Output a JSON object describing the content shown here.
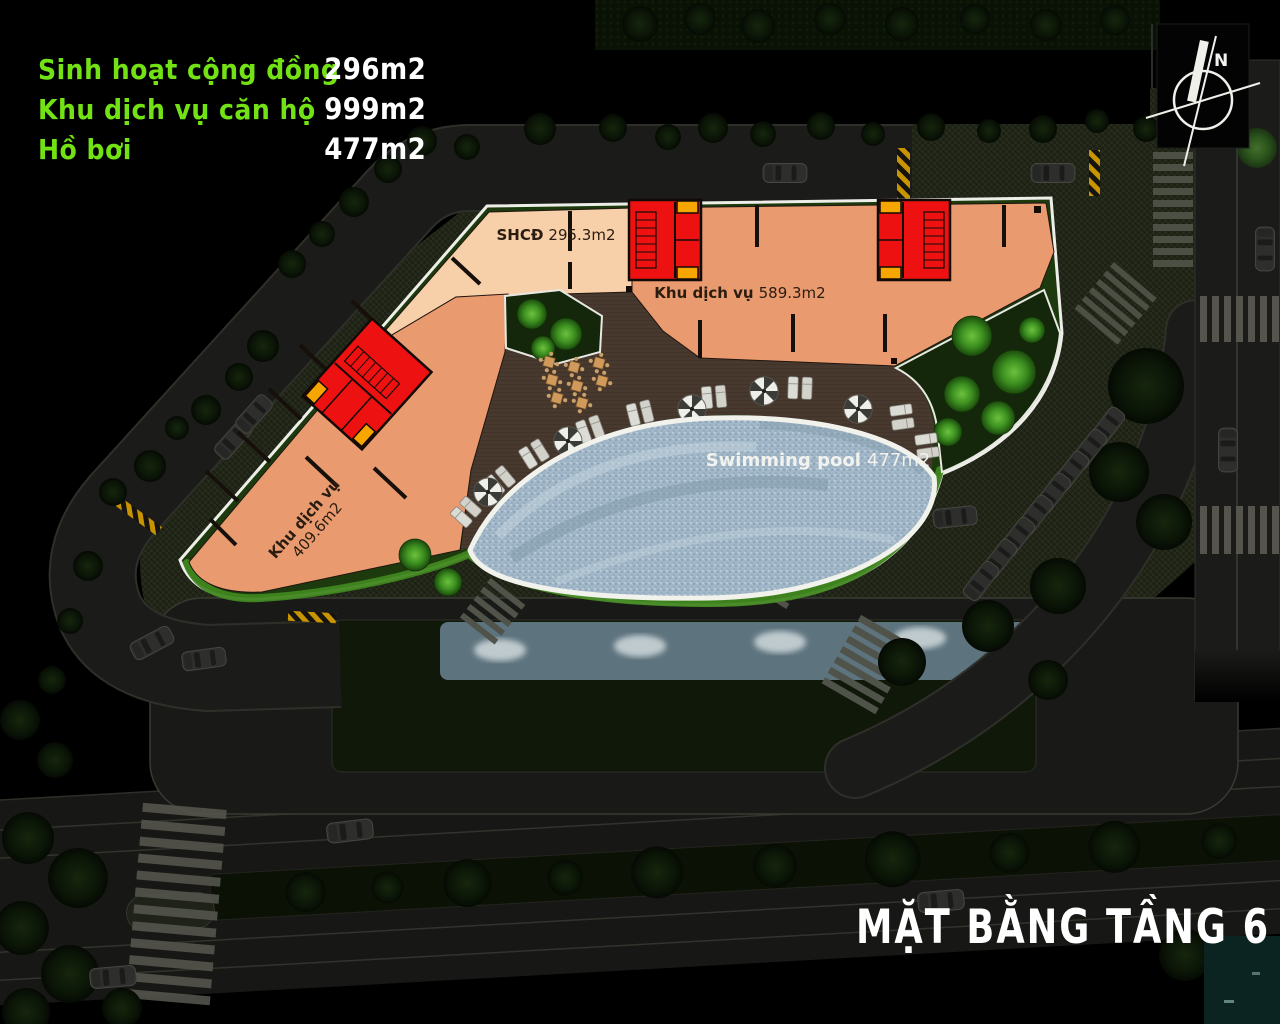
{
  "legend": {
    "items": [
      {
        "label": "Sinh hoạt cộng đồng",
        "value": "296m2"
      },
      {
        "label": "Khu dịch vụ căn hộ",
        "value": "999m2"
      },
      {
        "label": "Hồ bơi",
        "value": "477m2"
      }
    ],
    "label_color": "#72e214",
    "value_color": "#ffffff"
  },
  "title": "MẶT BẰNG TẦNG 6",
  "compass": {
    "label": "N"
  },
  "plan_labels": {
    "shcd": {
      "name": "SHCĐ",
      "area": "295.3m2"
    },
    "service_right": {
      "name": "Khu dịch vụ",
      "area": "589.3m2"
    },
    "service_left_line1": "Khu dịch vụ",
    "service_left_line2": "409.6m2",
    "pool": {
      "name": "Swimming pool",
      "area": "477m2"
    }
  },
  "colors": {
    "community_area": "#f7d0a9",
    "service_area": "#e99b6f",
    "stair_core": "#ee1111",
    "elevator": "#f7a600",
    "pool_water": "#a2b8c8",
    "deck": "#48392e",
    "hedge_bright": "#3f861f",
    "hedge_dark": "#1d3a0e",
    "road": "#1b1b19",
    "background": "#000000"
  }
}
